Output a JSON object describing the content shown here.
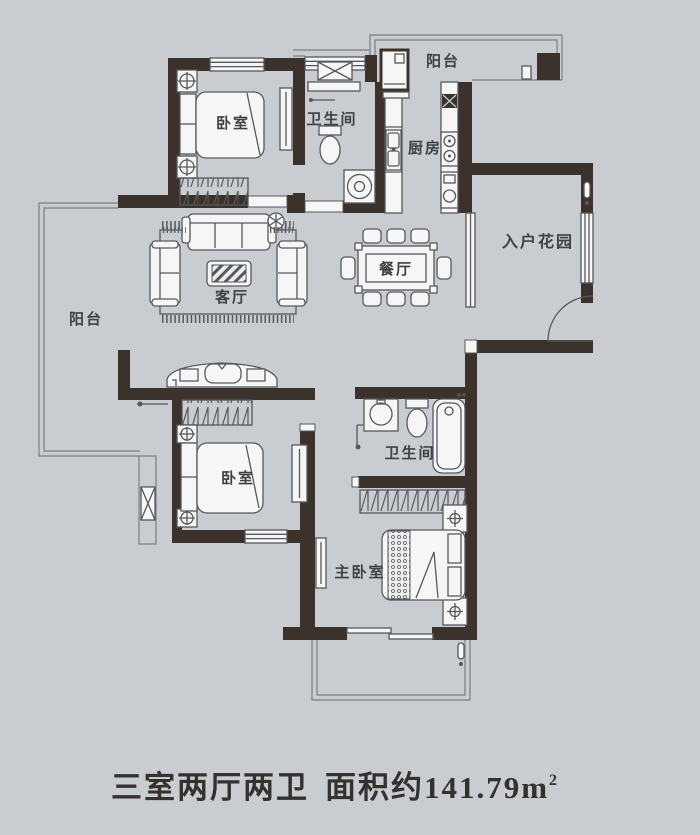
{
  "plan": {
    "rooms": {
      "balcony_top": {
        "label": "阳台"
      },
      "bathroom_top": {
        "label": "卫生间"
      },
      "kitchen": {
        "label": "厨房"
      },
      "bedroom_top": {
        "label": "卧室"
      },
      "entry_garden": {
        "label": "入户花园"
      },
      "dining": {
        "label": "餐厅"
      },
      "living": {
        "label": "客厅"
      },
      "balcony_left": {
        "label": "阳台"
      },
      "bedroom_mid": {
        "label": "卧室"
      },
      "bathroom_bottom": {
        "label": "卫生间"
      },
      "master_bedroom": {
        "label": "主卧室"
      }
    },
    "title": {
      "layout": "三室两厅两卫",
      "area_prefix": "面积约",
      "area_value": "141.79m",
      "area_superscript": "2"
    },
    "colors": {
      "background": "#c9ccd1",
      "wall": "#3a322b",
      "line": "#55585c",
      "text": "#3f4245",
      "title_text": "#34312e"
    }
  }
}
